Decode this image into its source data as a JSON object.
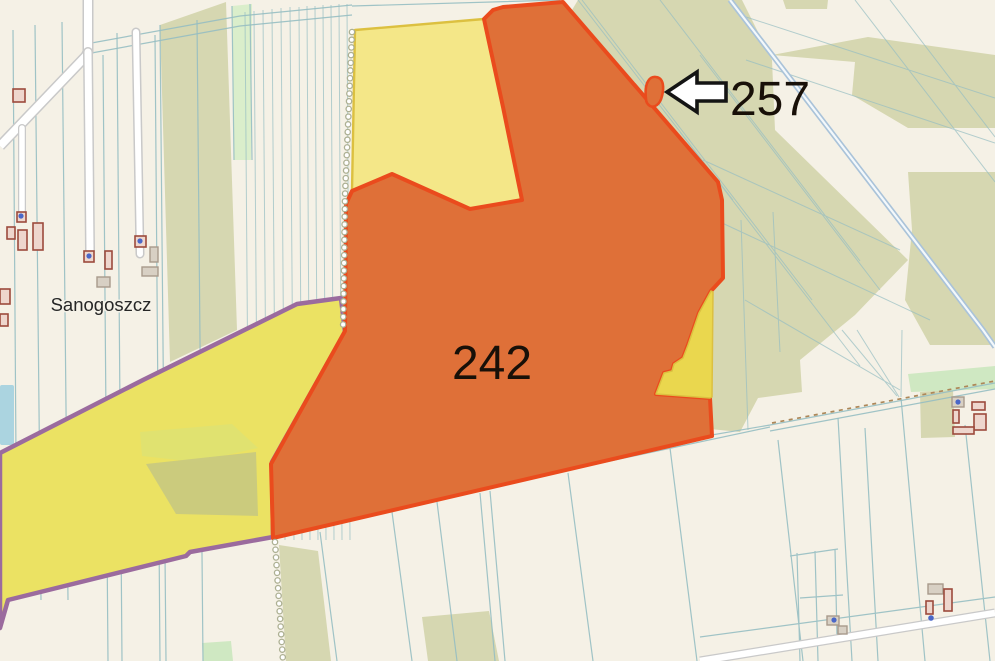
{
  "map": {
    "place_labels": [
      {
        "name": "Sanogoszcz"
      }
    ],
    "parcels": [
      {
        "id": "242",
        "label": "242",
        "kind": "highlighted-parcel-orange"
      },
      {
        "id": "257",
        "label": "257",
        "kind": "highlighted-parcel-orange-small"
      }
    ],
    "annotations": {
      "arrow_icon": "left-arrow",
      "arrow_points_to": "257"
    }
  },
  "colors": {
    "background": "#f5f1e6",
    "field-line": "#96bec2",
    "woodland": "#d6d7b1",
    "grass-light": "#cfe8c2",
    "grass-pale": "#daeecb",
    "parcel-orange-fill": "#df7038",
    "parcel-orange-stroke": "#ea4b1d",
    "parcel-yellow-fill": "#f4e788",
    "parcel-yellow-stroke": "#dcc040",
    "parcel-wedge-fill": "#ead74e",
    "parcel-lower-yellow-fill": "#ebe263",
    "boundary-purple": "#9b6b9e",
    "water": "#abd4e0",
    "road-casing": "#c9c9c9",
    "road-blue": "#aac3d9",
    "track-dash": "#ad8758",
    "building-red-fill": "#eed6cd",
    "building-red-stroke": "#9c4a3c",
    "building-gray-fill": "#d8d0c4",
    "building-gray-stroke": "#a89a8c",
    "address-dot": "#4a67c8",
    "label-dark": "#181008",
    "label-place": "#262626"
  }
}
